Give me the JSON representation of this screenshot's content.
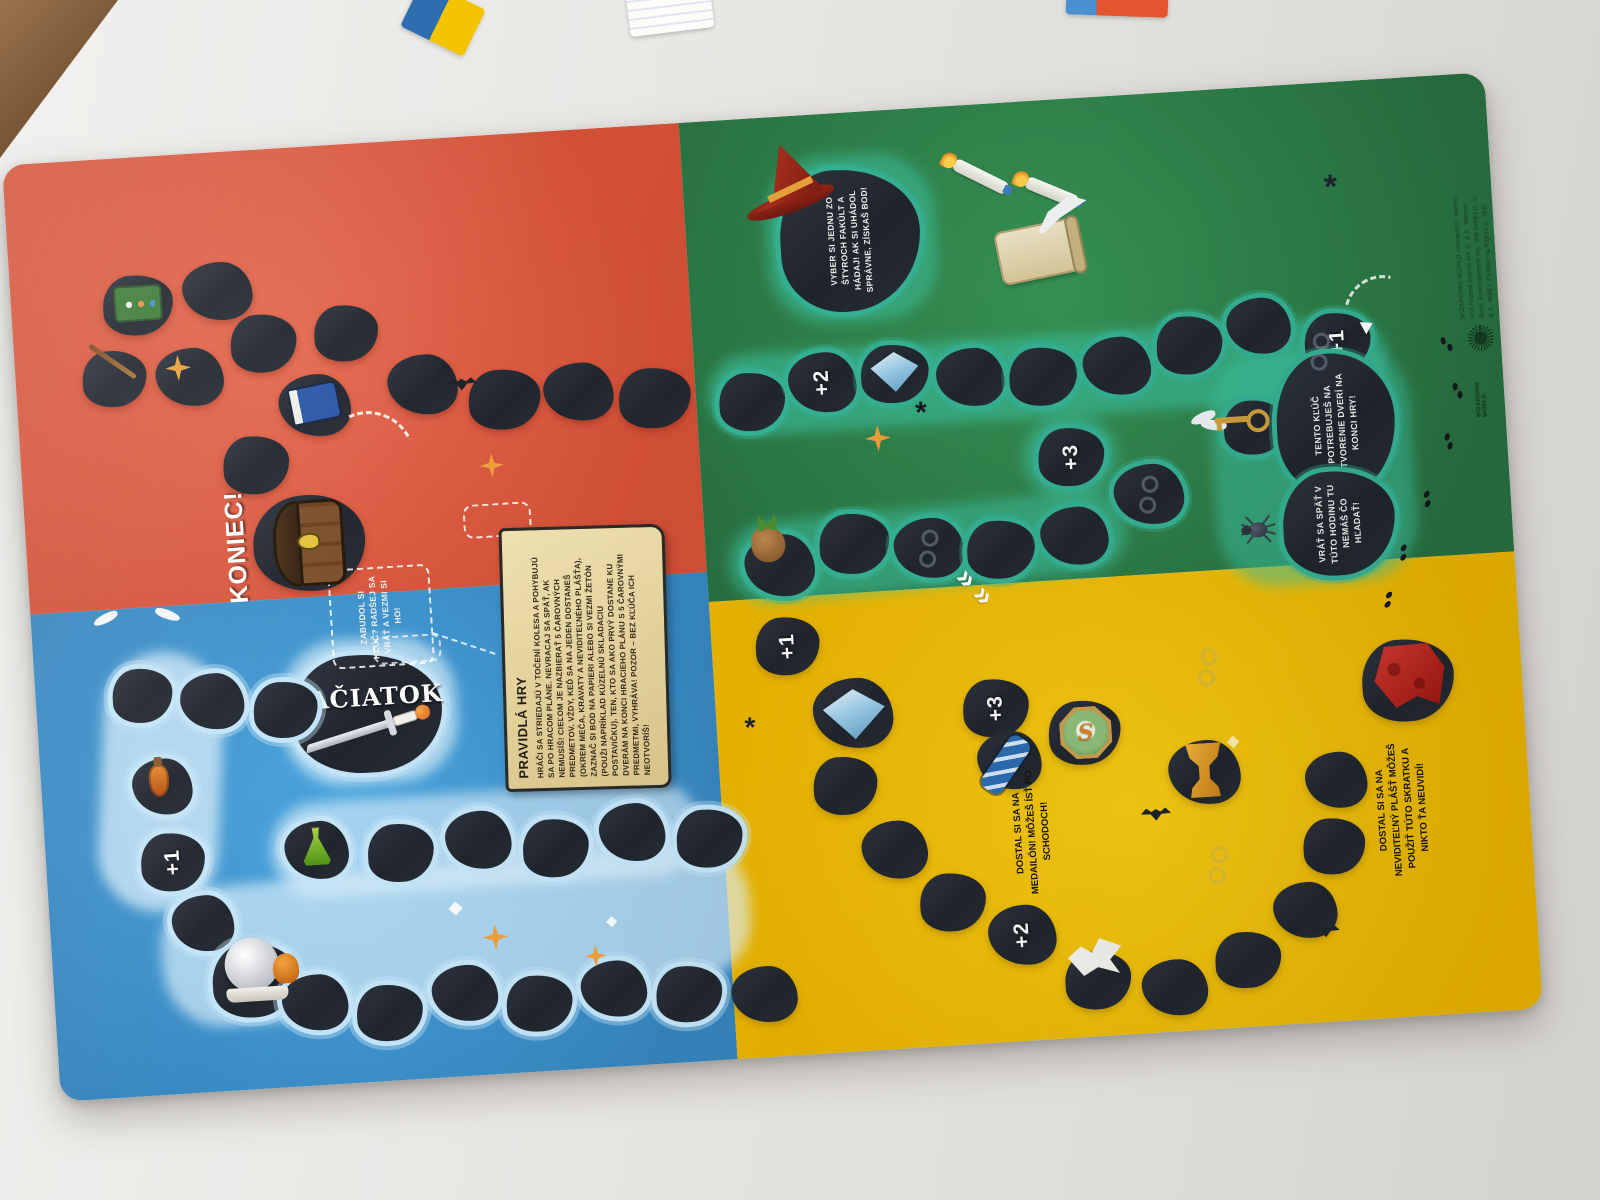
{
  "board": {
    "quadrant_colors": {
      "top_left_red": "#d9543c",
      "top_right_green": "#2e8c4d",
      "bottom_left_blue": "#3f9bd8",
      "bottom_right_yellow": "#f4c400",
      "path_stone": "#232830",
      "green_path_outline": "#36b294",
      "blue_path_outline": "#c3e4f7",
      "parchment": "#e8d49a"
    },
    "start_label": "ZAČIATOK",
    "end_label": "KONIEC!",
    "locket_letter": "S",
    "bonus": {
      "blue_plus1": "+1",
      "yellow_entry_plus1": "+1",
      "green_plus2": "+2",
      "green_plus3": "+3",
      "green_end_plus1": "+1",
      "yellow_plus3": "+3",
      "yellow_plus2": "+2"
    },
    "rules": {
      "title": "PRAVIDLÁ HRY",
      "body": "HRÁČI SA STRIEDAJÚ V TOČENÍ KOLESA A POHYBUJÚ SA PO HRACOM PLÁNE. NEVRACAJ SA SPÄŤ, AK NEMUSÍŠ! CIEĽOM JE NAZBIERAŤ 5 ČAROVNÝCH PREDMETOV. VŽDY, KEĎ SA NA JEDEN DOSTANEŠ (OKREM MEČA, KRAVATY A NEVIDITEĽNÉHO PLÁŠŤA), ZAZNAČ SI BOD NA PAPIERI ALEBO SI VEZMI ŽETÓN (POUŽI NAPRÍKLAD KÚZELNÚ SKLADACIU POSTAVIČKU). TEN, KTO SA AKO PRVÝ DOSTANE KU DVERÁM NA KONCI HRACIEHO PLÁNU S 5 ČAROVNÝMI PREDMETMI, VYHRÁVA! POZOR – BEZ KĽÚČA ICH NEOTVORÍŠ!"
    },
    "notes": {
      "forgot_key": "ZABUDOL SI KĽÚČ? RADŠEJ SA VRÁŤ A VEZMI SI HO!",
      "sorting_hat": "VYBER SI JEDNU ZO ŠTYROCH FAKÚLT A HÁDAJ! AK SI UHÁDOL SPRÁVNE, ZÍSKAŠ BOD!",
      "winged_key": "TENTO KĽÚČ POTREBUJEŠ NA OTVORENIE DVERÍ NA KONCI HRY!",
      "spider": "VRÁŤ SA SPÄŤ V TÚTO HODINU TU NEMÁŠ ČO HĽADAŤ!",
      "locket": "DOSTAL SI SA NA MEDAILÓN! MÔŽEŠ ÍSŤ PO SCHODOCH!",
      "cloak": "DOSTAL SI SA NA NEVIDITEĽNÝ PLÁŠŤ MÔŽEŠ POUŽIŤ TÚTO SKRATKU A NIKTO ŤA NEUVIDÍ!"
    },
    "footer": {
      "logo": "WIZARDING WORLD",
      "copyright": "WIZARDING WORLD characters, names and related indicia are © & ™ Warner Bros. Entertainment Inc. WB SHIELD: © & ™ WBEI. Publishing Rights © JKR. (s21)"
    },
    "icons": {
      "treasure-chest-icon": "locked treasure chest",
      "sword-icon": "silver sword",
      "golden-snitch-icon": "winged golden ball",
      "potion-bottle-icon": "orange potion",
      "green-flask-icon": "green flask",
      "crystal-ball-icon": "crystal ball on stand",
      "blue-book-icon": "blue book",
      "potions-kit-icon": "green potion kit",
      "wand-icon": "magic wand",
      "sorting-hat-icon": "red wizard hat",
      "candle-icon": "floating candle",
      "scroll-quill-icon": "scroll with quill",
      "blue-gem-icon": "small blue gem",
      "diadem-gem-icon": "large blue gem",
      "winged-key-icon": "flying key",
      "spider-icon": "spider",
      "mandrake-icon": "mandrake root",
      "slytherin-locket-icon": "green locket with letter S",
      "ravenclaw-tie-icon": "blue striped tie",
      "goblet-icon": "golden goblet",
      "invisibility-cloak-icon": "red cloak",
      "owl-icon": "white bird",
      "glasses-icon": "round glasses with scar",
      "bat-icon": "bat silhouette",
      "footprints-icon": "footprint trail",
      "star-icon": "star sparkle"
    }
  }
}
